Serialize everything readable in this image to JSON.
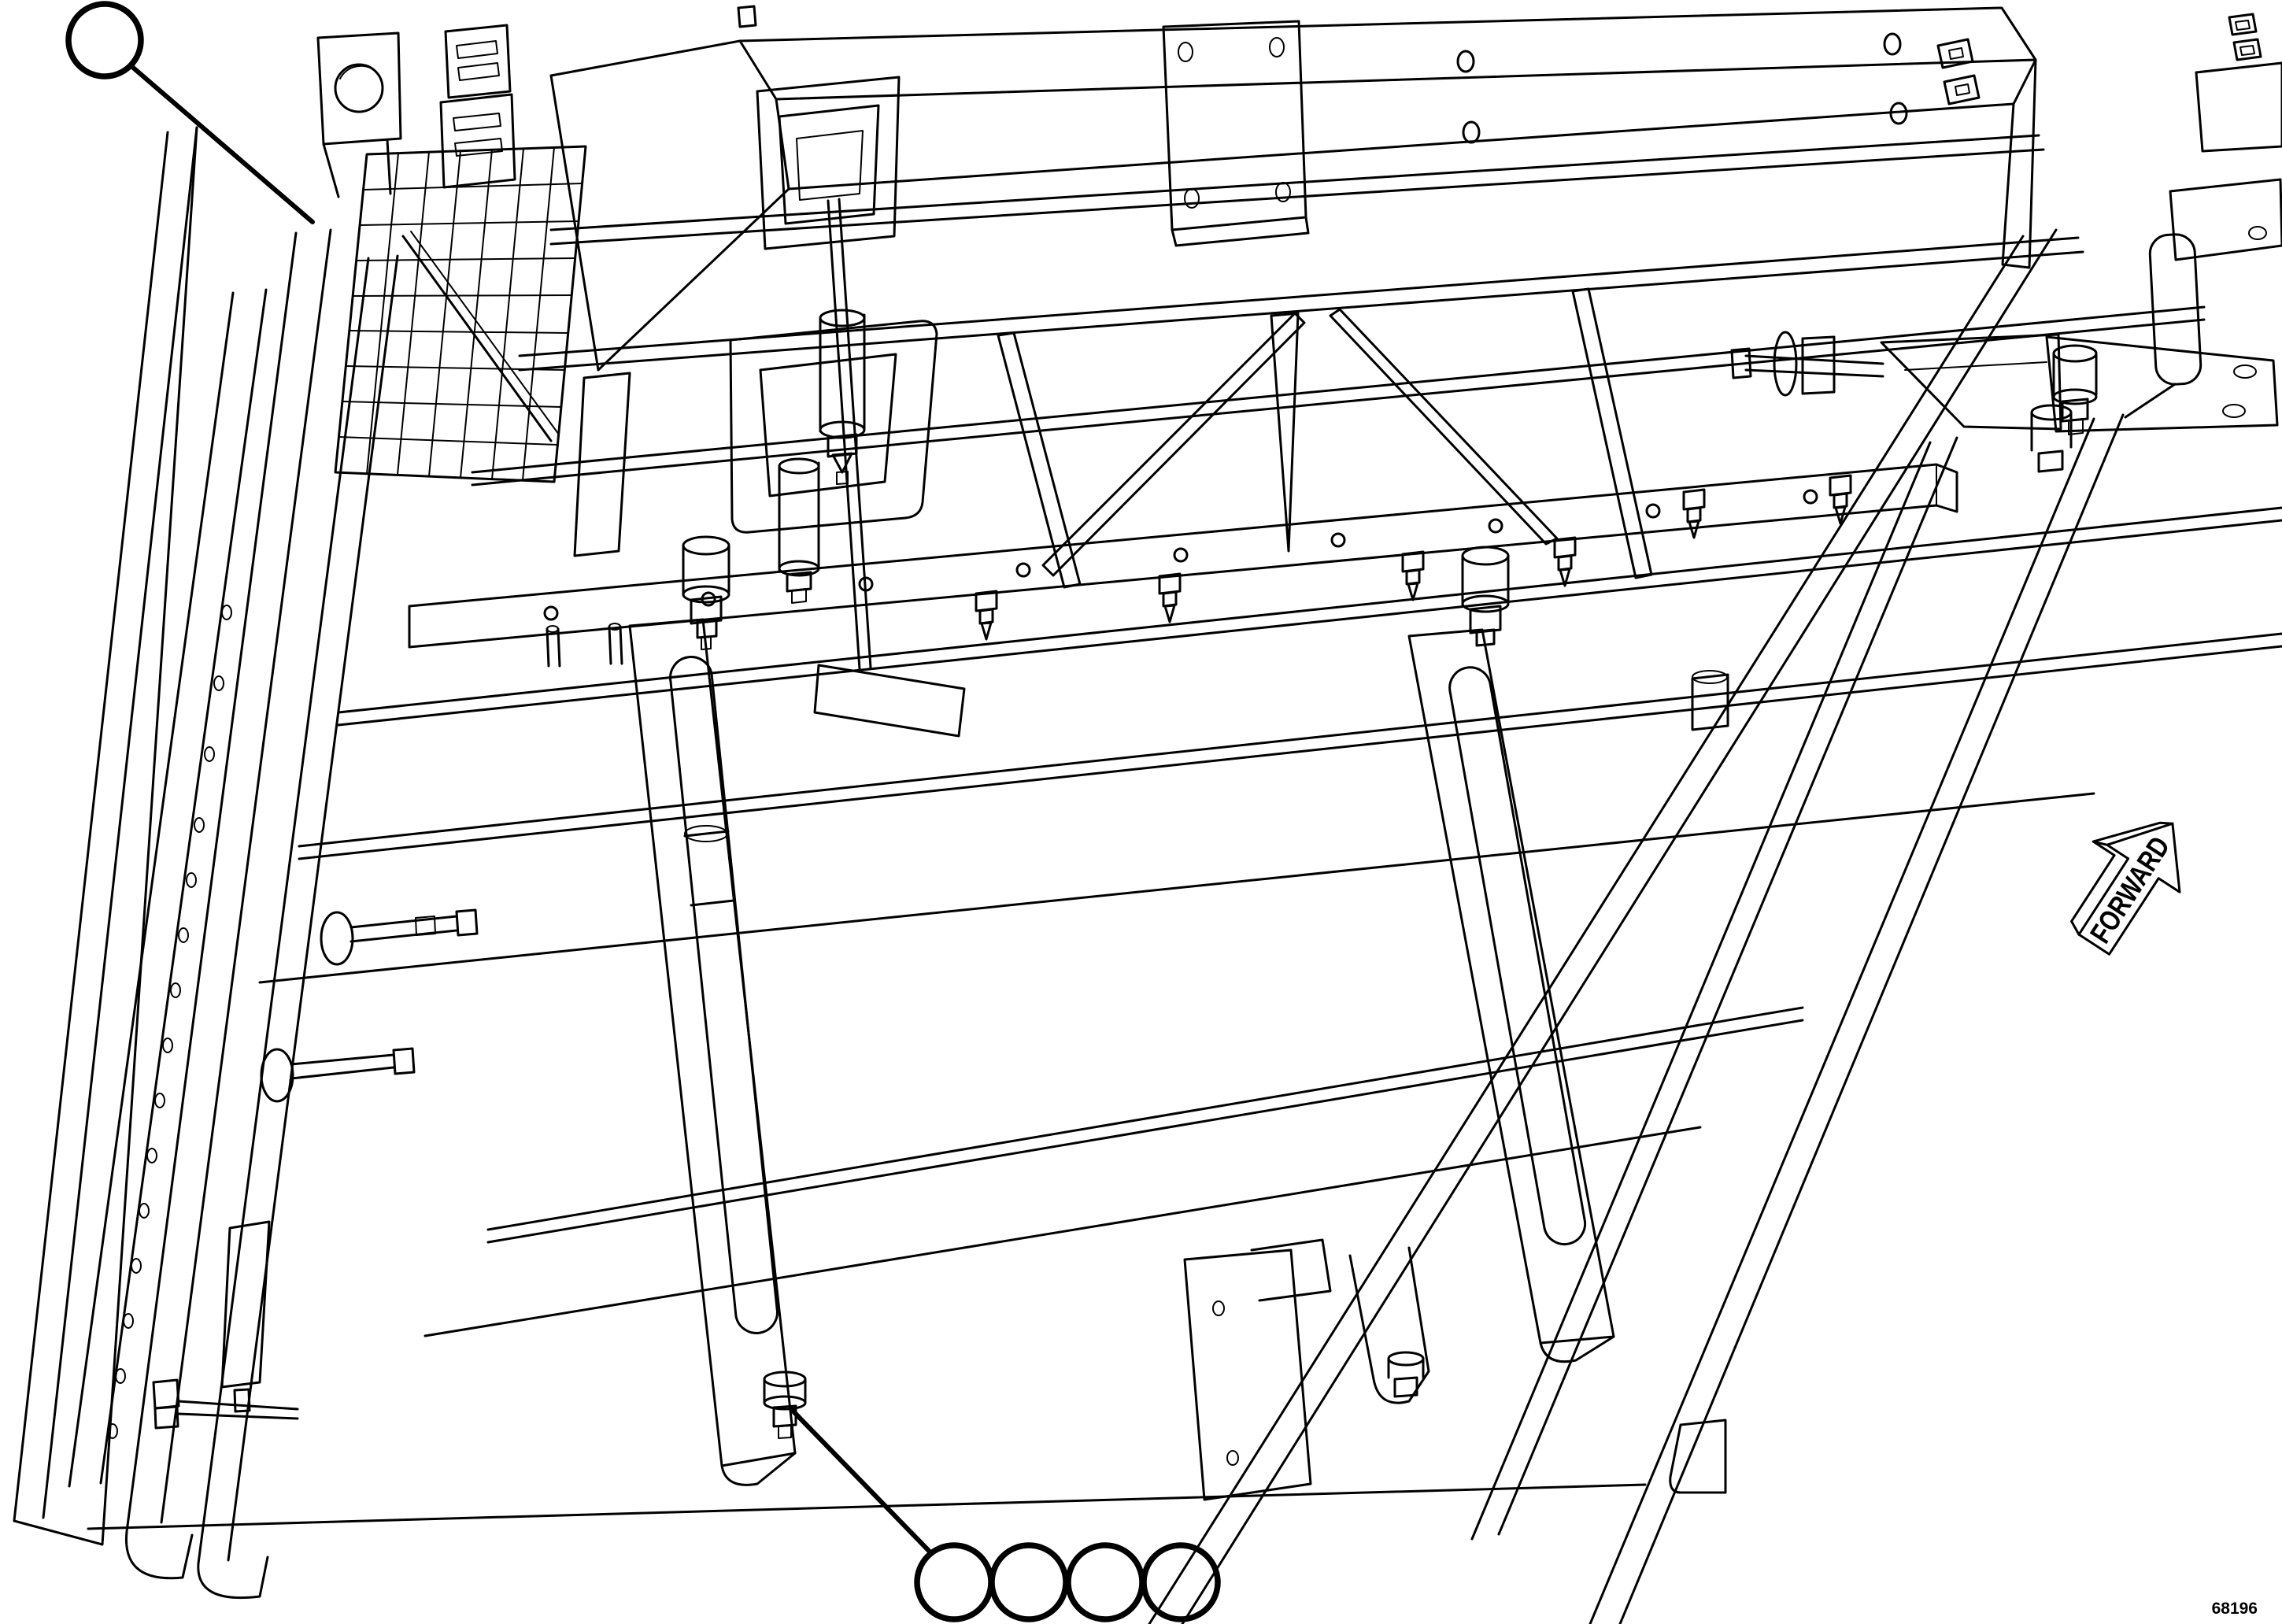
{
  "figure": {
    "type": "isometric-parts-line-drawing",
    "subject": "trailer frame underside assembly",
    "drawing_number": "68196",
    "direction_label": "FORWARD"
  },
  "callouts": {
    "top_left": {
      "label": "",
      "shape": "circle"
    },
    "bottom_row": [
      {
        "label": "",
        "shape": "circle"
      },
      {
        "label": "",
        "shape": "circle"
      },
      {
        "label": "",
        "shape": "circle"
      },
      {
        "label": "",
        "shape": "circle"
      }
    ]
  },
  "colors": {
    "line": "#000000",
    "background": "#ffffff"
  }
}
